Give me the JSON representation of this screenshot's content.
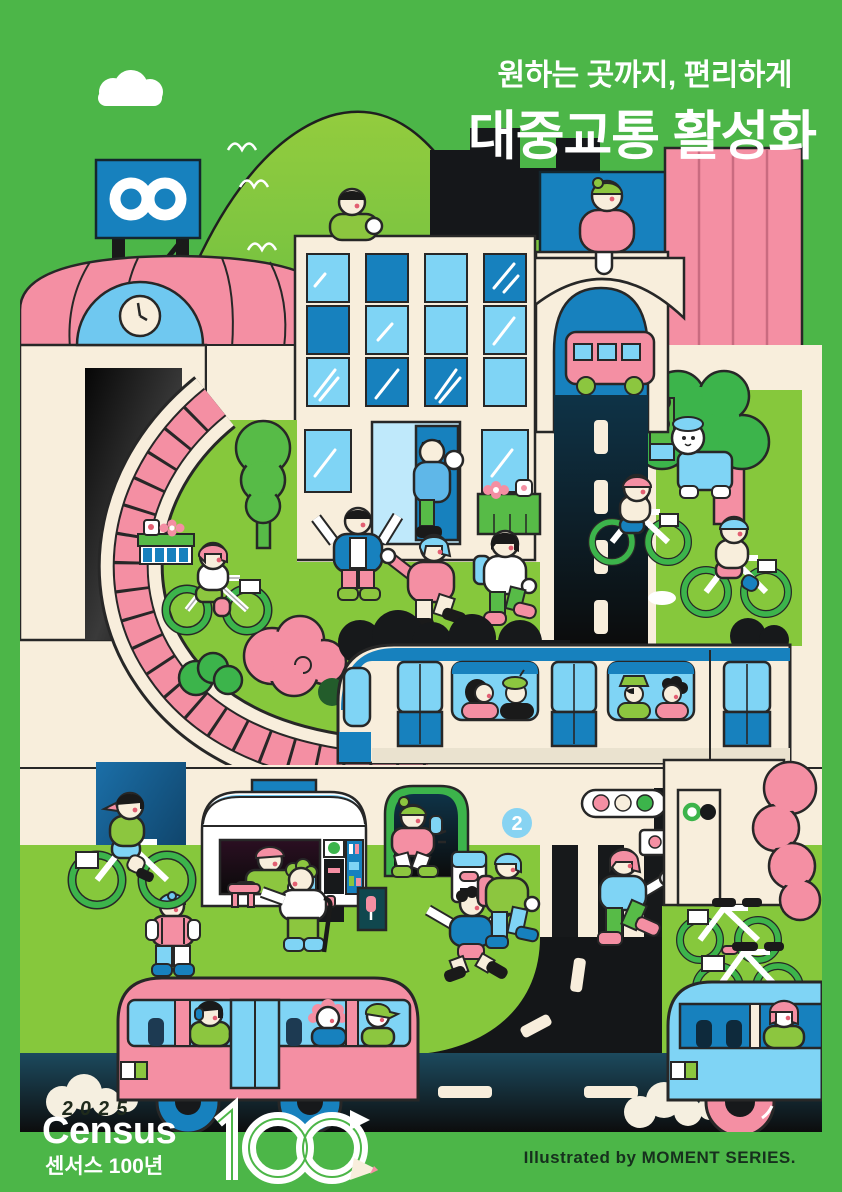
{
  "header": {
    "subtitle": "원하는 곳까지, 편리하게",
    "title": "대중교통 활성화"
  },
  "badge": {
    "number": "2"
  },
  "footer": {
    "year": "2025",
    "logo_en": "Census",
    "logo_ko": "센서스 100년",
    "logo_mark": "1∞",
    "credit": "Illustrated by MOMENT SERIES."
  },
  "palette": {
    "background_green": "#4CB648",
    "grass_green": "#86C83C",
    "hill_lime": "#7CC63F",
    "leaf_green": "#3CB44B",
    "clothes_green": "#8CC63F",
    "pink": "#F48FA3",
    "cream": "#F8EEDC",
    "blue": "#1781BE",
    "light_blue": "#7FD4F5",
    "sky_blue": "#6FC8F0",
    "ink": "#272727",
    "road_dark": "#17191B",
    "white": "#FFFFFF"
  },
  "scene": {
    "description": "Illustrated city poster promoting public transportation: station with clock, curved pink elevated track, office building, arch bridge with mini bus, subway train with passengers, food truck, subway entrance, traffic light, crosswalk with pedestrians, cyclists, shared bicycles, pink and blue city buses.",
    "elements": [
      "cloud",
      "hills",
      "infinity-signboard",
      "station-clock",
      "metro-logo",
      "curved-pink-track",
      "office-building",
      "pink-striped-building",
      "blue-building",
      "arch-bridge",
      "mini-bus",
      "city-road",
      "subway-train",
      "train-passengers",
      "food-truck",
      "subway-entrance",
      "ticket-gate",
      "traffic-light",
      "crosswalk",
      "pedestrians",
      "cyclists",
      "parked-bicycles",
      "trees",
      "bushes",
      "dog",
      "pink-city-bus",
      "blue-city-bus",
      "exhaust-clouds",
      "census-100-logo"
    ]
  }
}
